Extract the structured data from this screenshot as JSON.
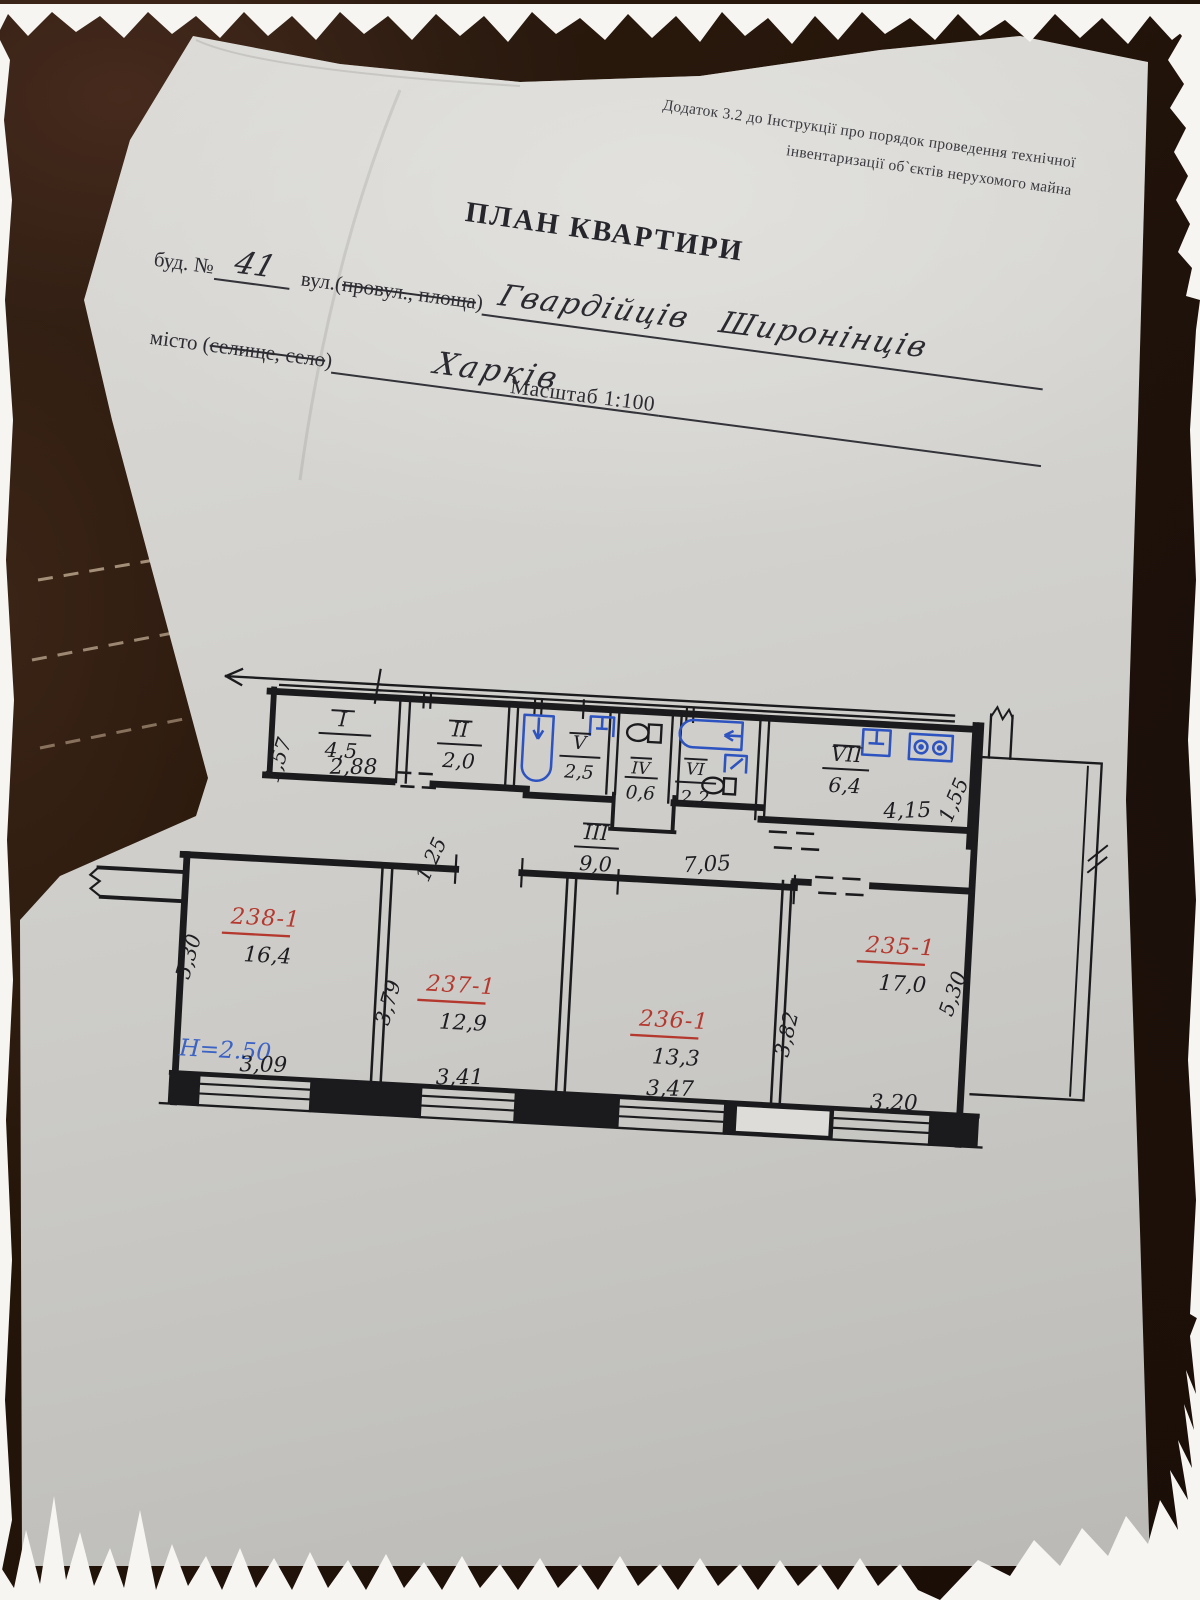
{
  "header": {
    "appendix_line1": "Додаток 3.2 до Інструкції про порядок проведення технічної",
    "appendix_line2": "інвентаризації об`єктів нерухомого майна",
    "title": "ПЛАН КВАРТИРИ"
  },
  "form": {
    "building_label": "буд. №",
    "building_number": "41",
    "street_label_prefix": "вул.(",
    "street_label_struck": "провул., площа",
    "street_label_suffix": ")",
    "street_name": "Гвардійців Широнінців",
    "city_label_prefix": "місто (",
    "city_label_struck": "селище, село",
    "city_label_suffix": ")",
    "city_name": "Харків",
    "scale": "Масштаб 1:100"
  },
  "plan": {
    "height_note": "H=2.50",
    "rooms": {
      "I": {
        "num": "I",
        "area": "4,5"
      },
      "II": {
        "num": "II",
        "area": "2,0"
      },
      "III": {
        "num": "III",
        "area": "9,0"
      },
      "IV": {
        "num": "IV",
        "area": "0,6"
      },
      "V": {
        "num": "V",
        "area": "2,5"
      },
      "VI": {
        "num": "VI",
        "area": "2,2"
      },
      "VII": {
        "num": "VII",
        "area": "6,4"
      },
      "238-1": {
        "num": "238-1",
        "area": "16,4"
      },
      "237-1": {
        "num": "237-1",
        "area": "12,9"
      },
      "236-1": {
        "num": "236-1",
        "area": "13,3"
      },
      "235-1": {
        "num": "235-1",
        "area": "17,0"
      }
    },
    "dims": {
      "room_i_width": "2,88",
      "room_i_depth": "1,57",
      "kitchen_width": "4,15",
      "kitchen_depth": "1,55",
      "corridor_width": "7,05",
      "corridor_left": "1,25",
      "r238_depth": "5,30",
      "r238_width": "3,09",
      "r237_depth": "3,79",
      "r237_width": "3,41",
      "r236_width": "3,47",
      "r236_depth": "3,82",
      "r235_depth": "5,30",
      "r235_width": "3,20"
    }
  },
  "colors": {
    "paper": "#d3d2ce",
    "leather": "#2e1b12",
    "ink": "#1e1e22",
    "room_number_red": "#b5382e",
    "fixture_blue": "#2d53c0",
    "note_blue": "#3b62c4"
  }
}
